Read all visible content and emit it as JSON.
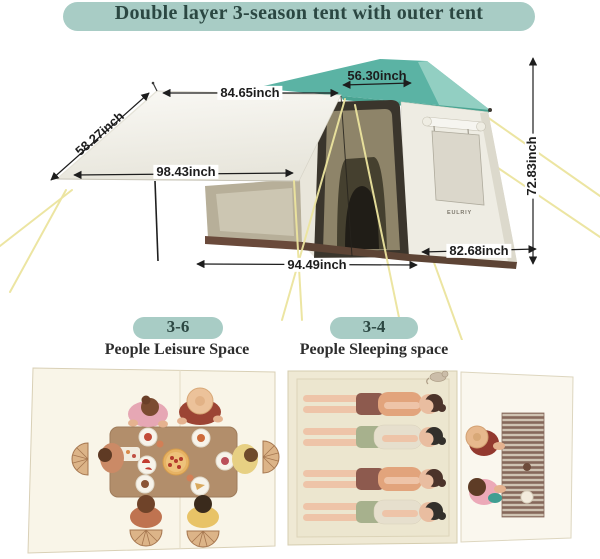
{
  "header": {
    "title": "Double layer 3-season tent with outer tent"
  },
  "tent": {
    "brand": "EULRIY",
    "dimensions": {
      "awning_top": "84.65inch",
      "roof_top": "56.30inch",
      "awning_side": "58.27inch",
      "awning_front": "98.43inch",
      "height": "72.83inch",
      "front_width": "94.49inch",
      "side_depth": "82.68inch"
    }
  },
  "capacity": [
    {
      "badge": "3-6",
      "caption": "People Leisure Space"
    },
    {
      "badge": "3-4",
      "caption": "People Sleeping space"
    }
  ],
  "colors": {
    "accent_teal": "#a8ccc5",
    "roof_teal": "#5bb3a4",
    "title_text": "#2b4742",
    "dimension_text": "#1d1d1d",
    "guy_line": "#ece49e",
    "skirt_brown": "#5d4435"
  }
}
